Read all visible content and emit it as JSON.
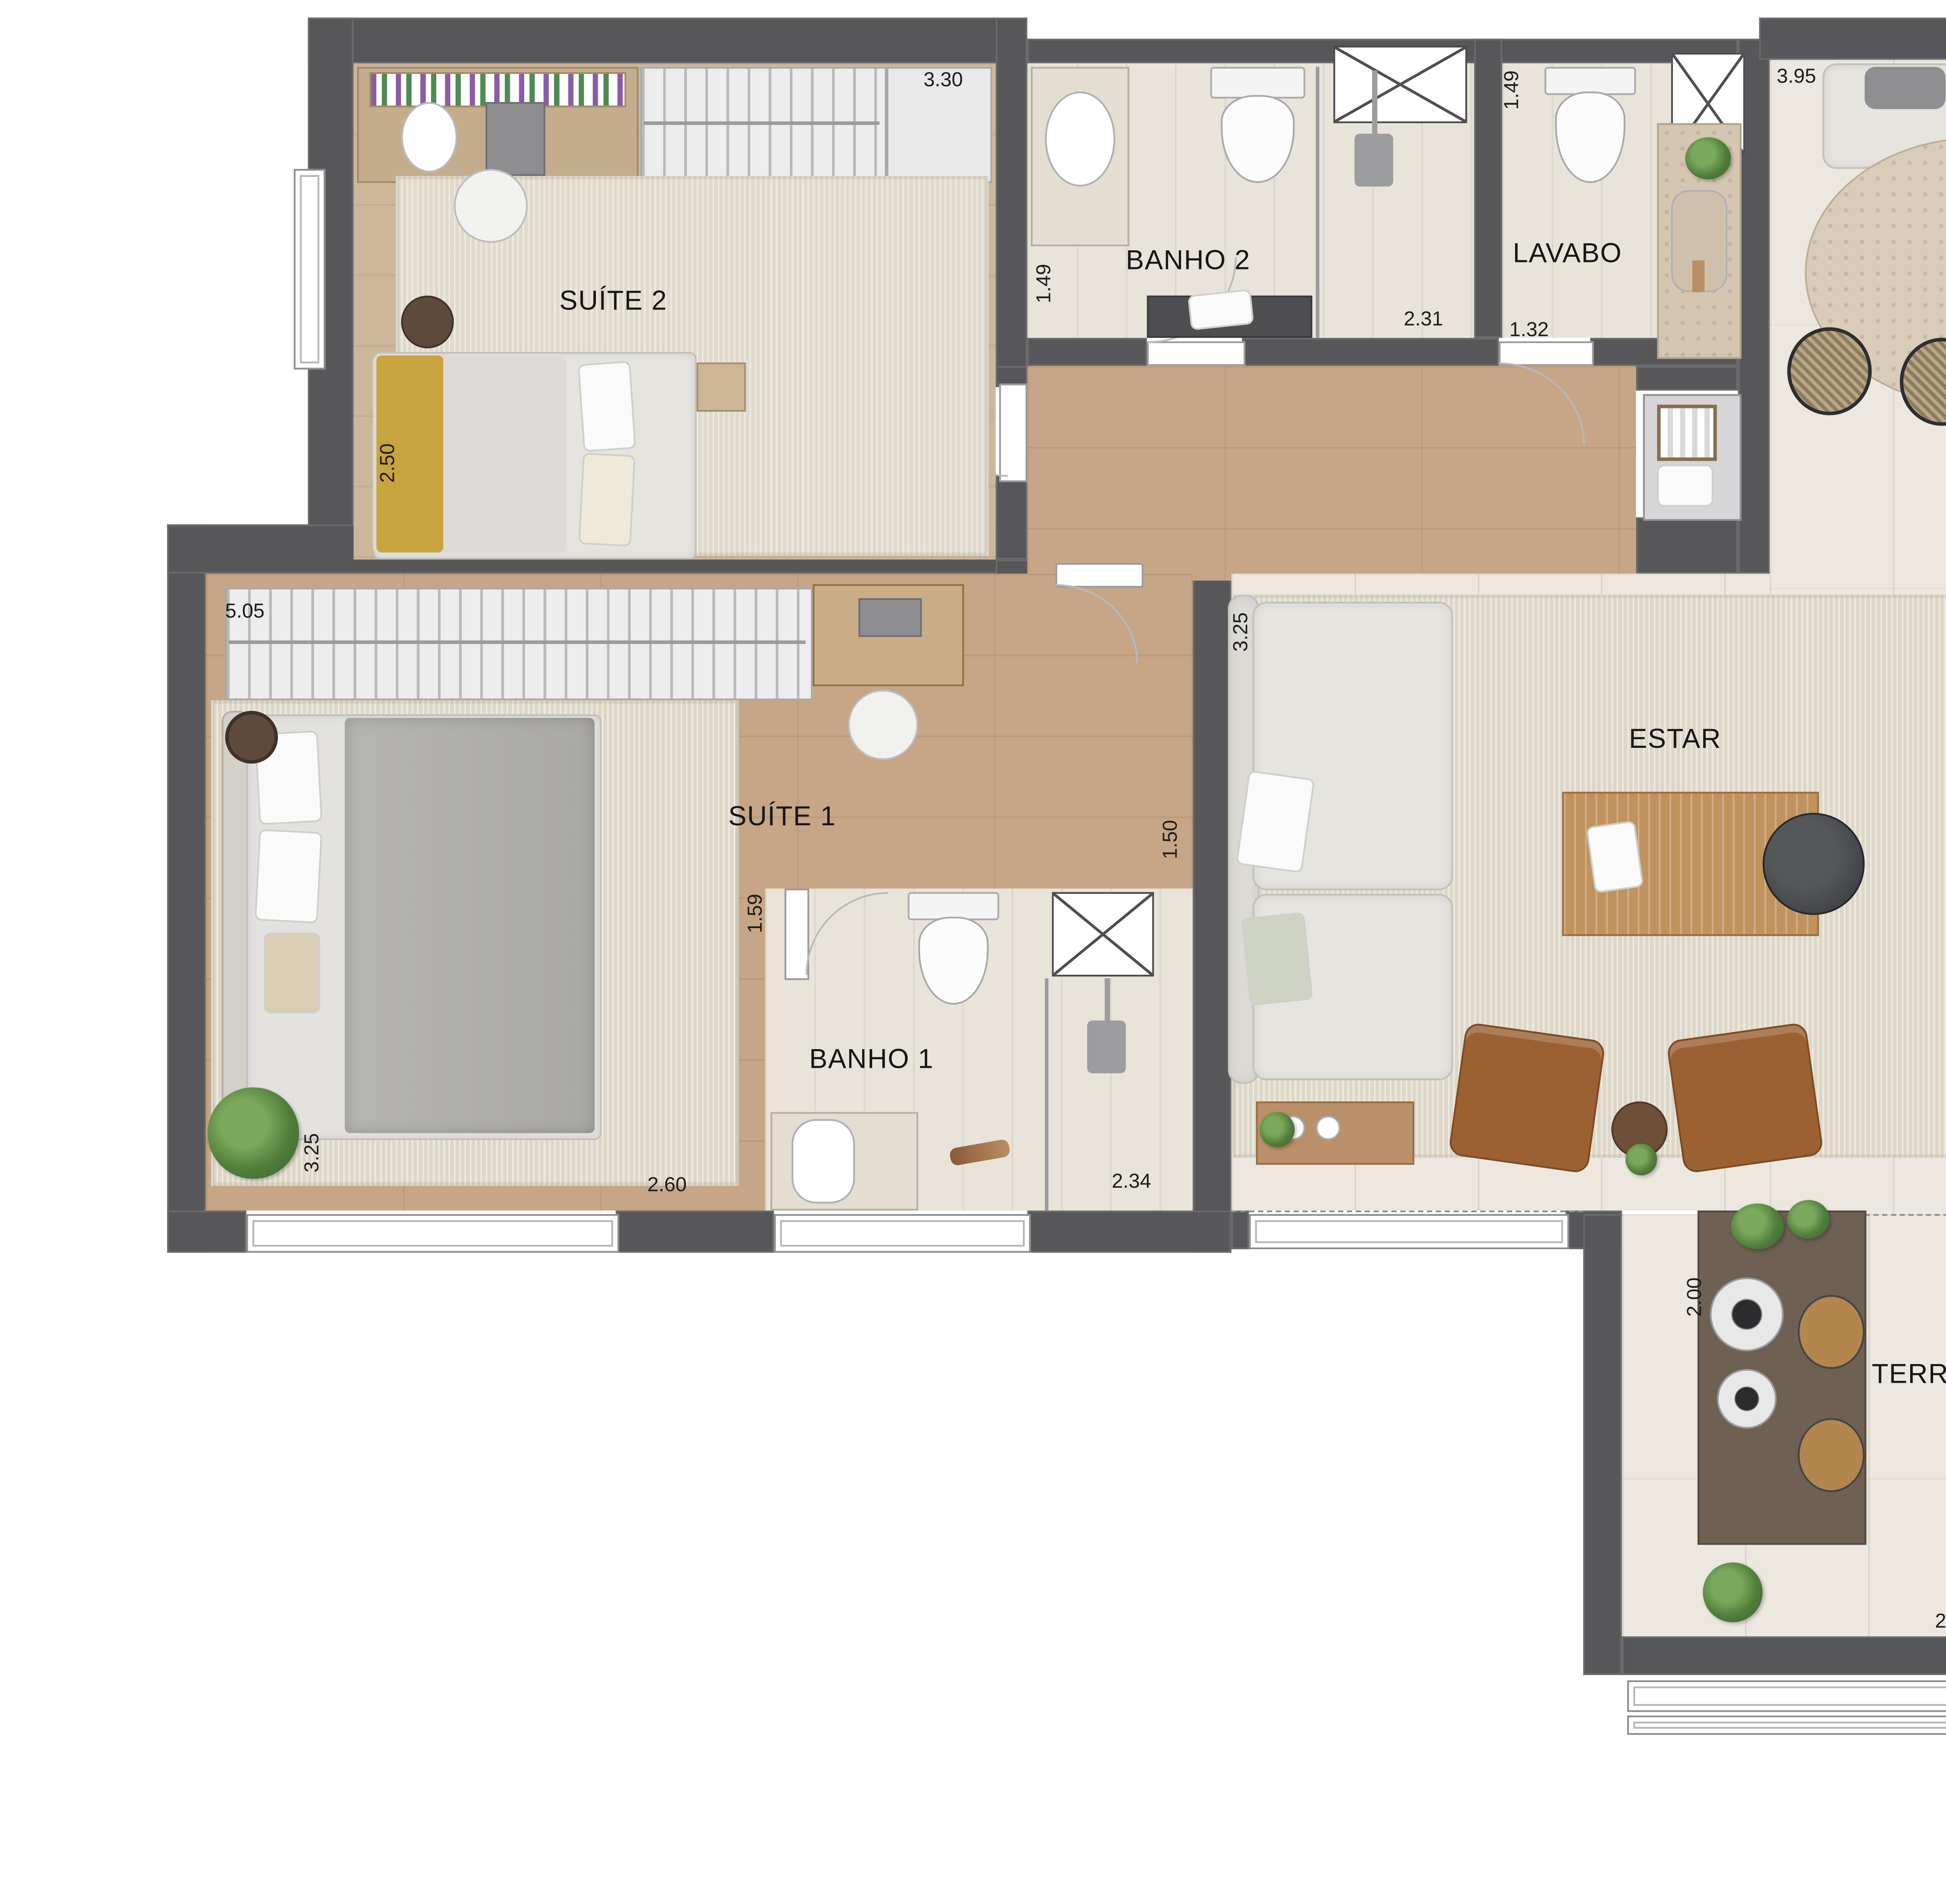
{
  "plan": {
    "type": "apartment-floor-plan",
    "rooms": {
      "suite2": {
        "label": "SUÍTE 2"
      },
      "banho2": {
        "label": "BANHO 2"
      },
      "lavabo": {
        "label": "LAVABO"
      },
      "jantar": {
        "label": "JANTAR"
      },
      "suite1": {
        "label": "SUÍTE 1"
      },
      "banho1": {
        "label": "BANHO 1"
      },
      "estar": {
        "label": "ESTAR"
      },
      "cozinha": {
        "label": "COZINHA"
      },
      "terraco": {
        "label": "TERRAÇO"
      },
      "terraco_servico": {
        "l1": "TERRAÇO",
        "l2": "DE",
        "l3": "SERVIÇO"
      }
    },
    "dims": {
      "suite2_w": "3.30",
      "suite2_d": "2.50",
      "banho2_d": "1.49",
      "banho2_w": "2.31",
      "lavabo_d": "1.49",
      "lavabo_w": "1.32",
      "jantar_w": "3.95",
      "jantar_d": "4.78",
      "suite1_w": "5.05",
      "suite1_d": "3.25",
      "suite1_w2": "2.60",
      "hall_w": "1.50",
      "banho1_d": "1.59",
      "banho1_w": "2.34",
      "estar_d": "3.25",
      "estar_panel": "5.91",
      "estar_w": "5.06",
      "cozinha_w": "1.62",
      "terraco_d": "2.00",
      "terraco_w": "2.41",
      "servico_w": "1.39"
    },
    "colors": {
      "wall": "#57575a",
      "wood_floor": "#c6a686",
      "suite2_floor": "#cdb79b",
      "living_tile": "#ece8e0",
      "bath_tile": "#e8e4da",
      "rug": "#e0dacb",
      "granite_counter": "#dad7d1",
      "stone_counter": "#d5c6b2",
      "bar_counter": "#6e6052",
      "leather_armchair": "#9c6133",
      "throw_blanket": "#c8a43e",
      "plant_green": "#4f7d3a",
      "label_text": "#161616"
    },
    "icons": [
      "closet-hangers-icon",
      "toilet-icon",
      "sink-icon",
      "shower-head-icon",
      "duct-x-icon",
      "dining-table-icon",
      "fridge-icon",
      "cooktop-icon",
      "tv-icon",
      "washer-icon",
      "bbq-grill-icon",
      "plant-icon",
      "drying-rack-icon",
      "door-swing-icon"
    ]
  }
}
